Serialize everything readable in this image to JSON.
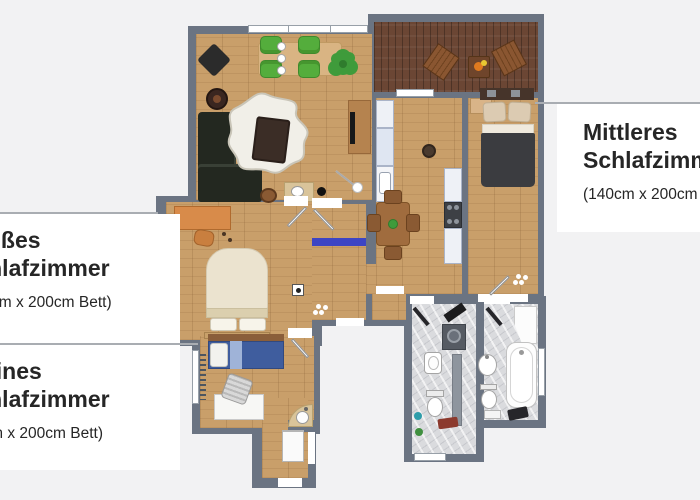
{
  "meta": {
    "description": "Apartment floor plan (top-down 3D render) with bedroom size callouts",
    "width": 700,
    "height": 500
  },
  "callouts": {
    "middle_bedroom": {
      "line1": "Mittleres",
      "line2": "Schlafzimmer",
      "size": "(140cm x 200cm Bett)",
      "side": "right"
    },
    "large_bedroom": {
      "line1": "Großes",
      "line2": "Schlafzimmer",
      "size": "(160cm x 200cm Bett)",
      "side": "left"
    },
    "small_bedroom": {
      "line1": "Kleines",
      "line2": "Schlafzimmer",
      "size": "(90cm x 200cm Bett)",
      "side": "left"
    }
  },
  "rooms": [
    "living-room",
    "balcony",
    "kitchen-dining",
    "middle-bedroom",
    "large-bedroom",
    "small-bedroom",
    "hallway",
    "wc",
    "bathroom",
    "entrance"
  ],
  "colors": {
    "bg": "#f2f2f3",
    "wall": "#6b7482",
    "wood": "#c99f6a",
    "deck": "#6b4634",
    "marble": "#dadbde",
    "label_bg": "#ffffff",
    "text": "#262626",
    "leader": "#a9adb2",
    "chair_green": "#54ad3c",
    "plant_green": "#3f9b3b",
    "sofa_dark": "#232820",
    "duvet_dark": "#3b3c40",
    "bed_cream": "#ebe3cf",
    "bed_blue": "#3f5d9e",
    "desk_orange": "#d88b4a",
    "runner_blue": "#3d45c4"
  }
}
